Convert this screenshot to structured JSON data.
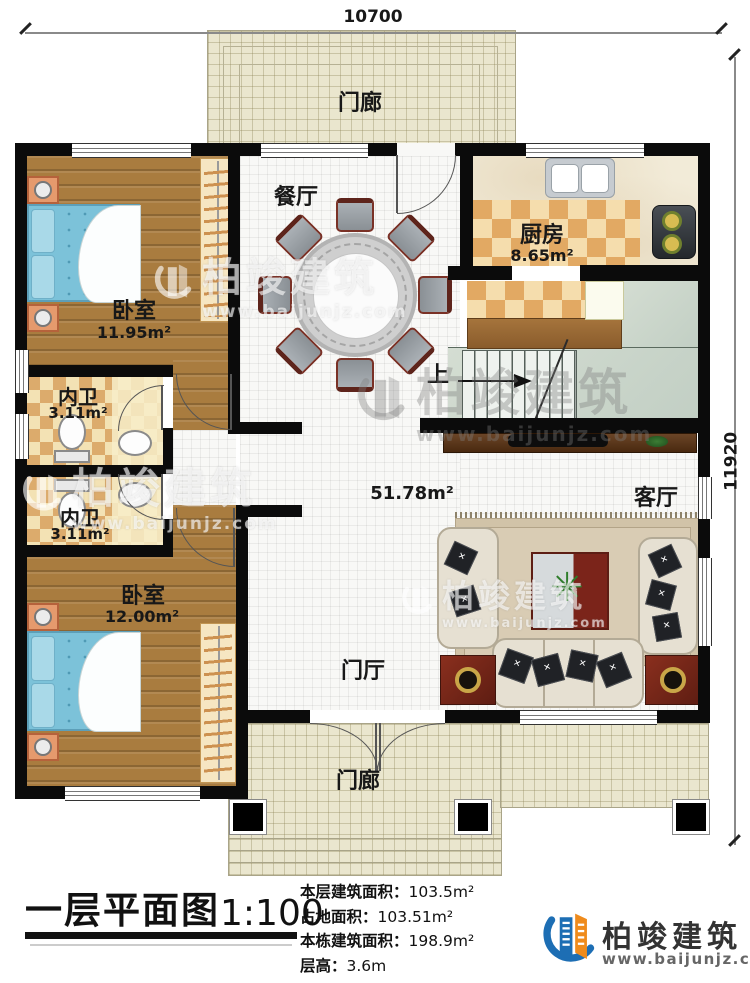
{
  "plan": {
    "dimensions": {
      "width_top": "10700",
      "height_right": "11920"
    },
    "rooms": {
      "porch_top": {
        "label": "门廊"
      },
      "dining": {
        "label": "餐厅"
      },
      "kitchen": {
        "label": "厨房",
        "area": "8.65m²"
      },
      "bedroom1": {
        "label": "卧室",
        "area": "11.95m²"
      },
      "bath1": {
        "label": "内卫",
        "area": "3.11m²"
      },
      "bath2": {
        "label": "内卫",
        "area": "3.11m²"
      },
      "bedroom2": {
        "label": "卧室",
        "area": "12.00m²"
      },
      "central": {
        "area": "51.78m²"
      },
      "living": {
        "label": "客厅"
      },
      "foyer": {
        "label": "门厅"
      },
      "porch_bottom": {
        "label": "门廊"
      },
      "stairs": {
        "up_label": "上"
      }
    }
  },
  "watermark": {
    "name": "柏竣建筑",
    "url": "www.baijunjz.com"
  },
  "footer": {
    "title": "一层平面图",
    "scale": "1:100",
    "stats": [
      {
        "label": "本层建筑面积：",
        "value": "103.5m²"
      },
      {
        "label": "占地面积：",
        "value": "103.51m²"
      },
      {
        "label": "本栋建筑面积：",
        "value": "198.9m²"
      },
      {
        "label": "层高：",
        "value": "3.6m"
      }
    ],
    "brand": {
      "name": "柏竣建筑",
      "url": "www.baijunjz.com"
    }
  }
}
